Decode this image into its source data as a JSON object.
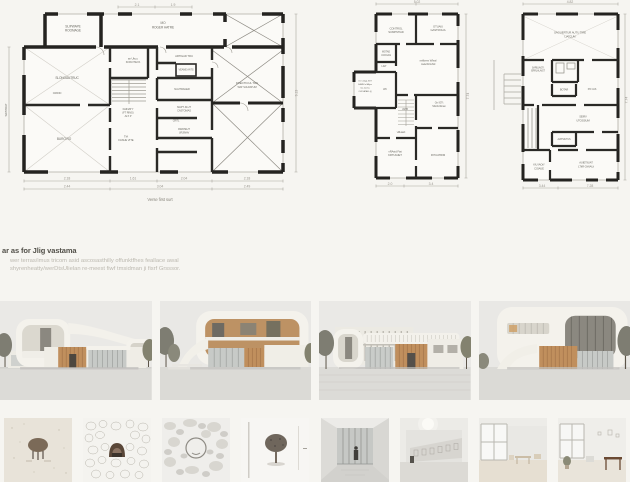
{
  "palette": {
    "background": "#f6f5f1",
    "plan_wall": "#242320",
    "plan_thin_line": "#b0ada5",
    "label_text": "#6e6d66",
    "heading_text": "#514f48",
    "body_text": "#bcb9b0",
    "wood": "#c08f5d",
    "sky": "#eae9e6",
    "ground": "#dcdbd7",
    "tree": "#7e7d72",
    "glass": "#c7cac7"
  },
  "summary": {
    "heading": "ar as for Jlig vastama",
    "line1": "wer terras/imus tricom asid ascosasthilly offunktfhes feallace awal",
    "line2": "shyrenheatty/werDtsUlielan re-meest fiwf tmsidman ji fisrf Grsssor."
  },
  "plan_a": {
    "caption": "Verse first surt",
    "labels": {
      "r1a": "SLIPWAPE",
      "r1b": "ROOMAGE",
      "r2a": "MO",
      "r2b": "ROGER HATRE",
      "r3": "SLONOAUTRUC",
      "r4": "CRIOD",
      "r5a": "an Ukcu.",
      "r5b": "KOKOTEYA",
      "r6": "ARTIGAD TRU",
      "r7": "VEANE AATS",
      "r8": "NAUTRAGER",
      "r9a": "FAINATY",
      "r9b": "(FT RING)",
      "r9c": "ALT. P",
      "r10a": "MAPT JILUT",
      "r10b": "CASTOMAS",
      "r11": "CRITL",
      "r12a": "RWATEUT",
      "r12b": "URJINAV",
      "r13a": "TIA",
      "r13b": "FASUE VITE",
      "r14": "BURO RO",
      "r15a": "FRECTICUL TRE",
      "r15b": "WAT SULDATUM",
      "side": "SAISTRUT"
    },
    "dims": {
      "t1": "2.1",
      "t2": "1.9",
      "b1": "2.18",
      "b2": "1.61",
      "b3": "2.04",
      "b4": "2.18",
      "c1": "2.44",
      "c2": "3.04",
      "c3": "2.49",
      "right": "9.13"
    }
  },
  "plan_b": {
    "labels": {
      "r1a": "CONTROL",
      "r1b": "SUMPSTIAD",
      "r2a": "OTUAIU",
      "r2b": "GASTROLIA",
      "r3a": "MOTAD",
      "r3b": "UCOGAS",
      "r4": "LIGT",
      "r5a": "On Crilagt JGIT",
      "r5b": "KAMM al IAlyre",
      "r5c": "tias lucima",
      "r5d": "OWI IATAR. (t)",
      "r6": "WC",
      "r7a": "nellizem Wleal",
      "r7b": "meleSOuNd",
      "r8a": "On IGTt",
      "r8b": "SIGUtd limten",
      "r9": "ASTB",
      "r10": "vRLiasrit",
      "r11a": "vRAsid Fiat",
      "r11b": "KRTUIAIET",
      "r12": "RYIUATRIM"
    },
    "dims": {
      "top": "5.02",
      "b1": "2.0",
      "b2": "3.4",
      "right": "7.74"
    }
  },
  "plan_c": {
    "labels": {
      "r1a": "SAGUERTUR AUTU TIRE",
      "r1b": "LIATCUM",
      "r2a": "SARILIAGTt",
      "r2b": "ERRLALAIST",
      "r3": "BOTAR",
      "r4": "PO CAS",
      "r5a": "SEIRV",
      "r5b": "UTOSSIUM",
      "r6": "AIATSIUTUS",
      "r7a": "KIU IAOtY",
      "r7b": "COIAUE",
      "r8a": "AUIETIUIAT",
      "r8b": "LTItR GIAIAUt"
    },
    "dims": {
      "top": "4.82",
      "b1": "3.44",
      "b2": "7.28",
      "right": "7.74"
    }
  }
}
